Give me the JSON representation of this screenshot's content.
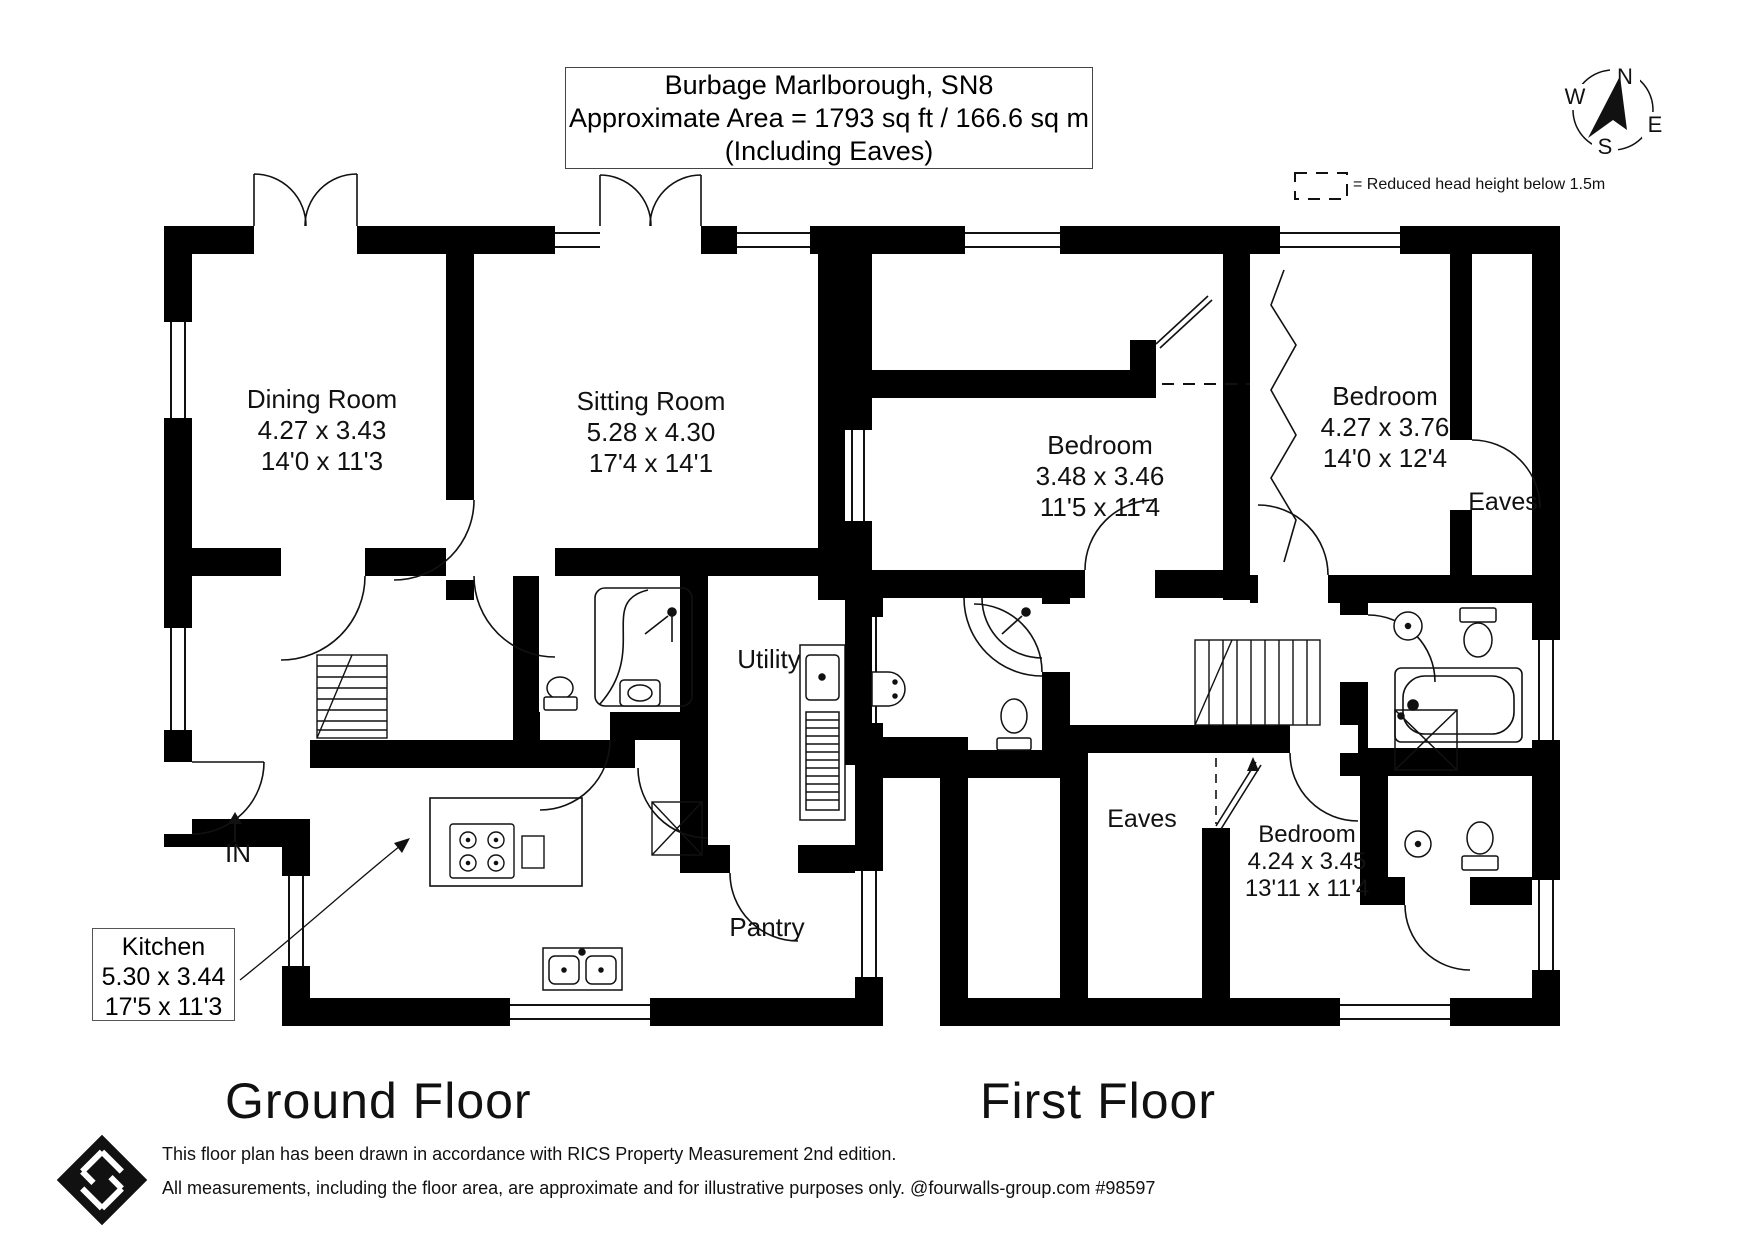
{
  "title_block": {
    "line1": "Burbage Marlborough, SN8",
    "line2": "Approximate Area = 1793 sq ft / 166.6 sq m",
    "line3": "(Including Eaves)"
  },
  "legend": {
    "text": "= Reduced head height below 1.5m"
  },
  "compass": {
    "north": "N",
    "east": "E",
    "south": "S",
    "west": "W"
  },
  "ground_floor": {
    "title": "Ground Floor",
    "entrance_label": "IN",
    "rooms": {
      "dining": {
        "name": "Dining Room",
        "metric": "4.27 x 3.43",
        "imperial": "14'0 x 11'3"
      },
      "sitting": {
        "name": "Sitting Room",
        "metric": "5.28 x 4.30",
        "imperial": "17'4 x 14'1"
      },
      "utility": {
        "name": "Utility"
      },
      "pantry": {
        "name": "Pantry"
      },
      "kitchen": {
        "name": "Kitchen",
        "metric": "5.30 x 3.44",
        "imperial": "17'5 x 11'3"
      }
    }
  },
  "first_floor": {
    "title": "First Floor",
    "rooms": {
      "bedroom1": {
        "name": "Bedroom",
        "metric": "3.48 x 3.46",
        "imperial": "11'5 x 11'4"
      },
      "bedroom2": {
        "name": "Bedroom",
        "metric": "4.27 x 3.76",
        "imperial": "14'0 x 12'4"
      },
      "bedroom3": {
        "name": "Bedroom",
        "metric": "4.24 x 3.45",
        "imperial": "13'11 x 11'4"
      },
      "eaves_right": {
        "name": "Eaves"
      },
      "eaves_left": {
        "name": "Eaves"
      }
    }
  },
  "footer": {
    "line1": "This floor plan has been drawn in accordance with RICS Property Measurement 2nd edition.",
    "line2": "All measurements, including the floor area, are approximate and for illustrative purposes only. @fourwalls-group.com #98597"
  },
  "colors": {
    "wall": "#000000",
    "line": "#1a1a1a",
    "background": "#ffffff"
  }
}
